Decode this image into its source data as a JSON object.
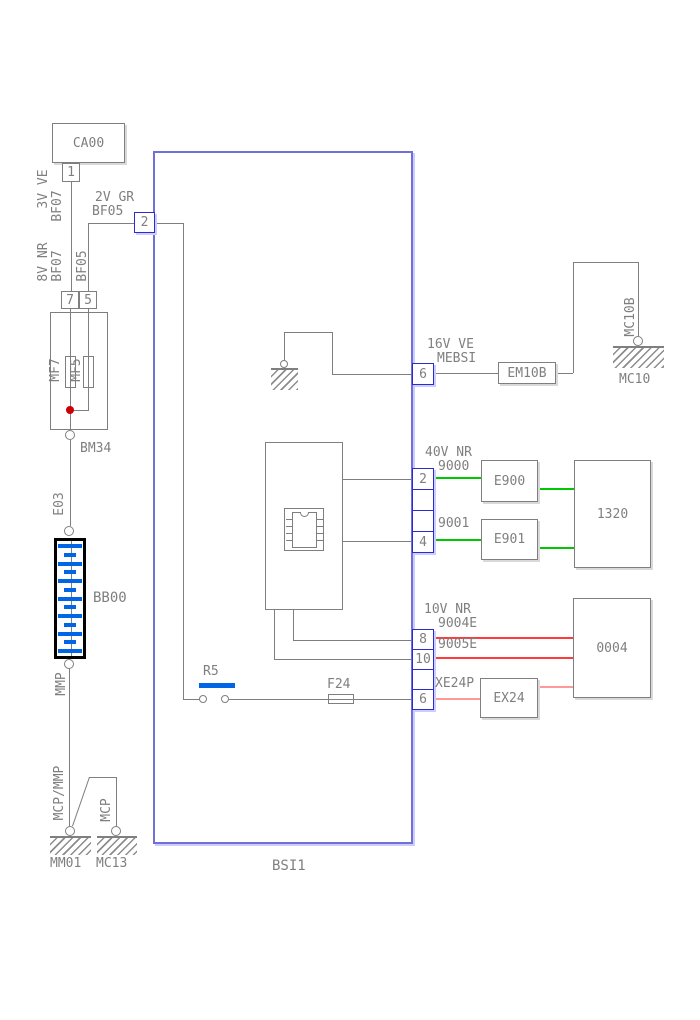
{
  "labels": {
    "ca00": "CA00",
    "p1": "1",
    "v3": "3V VE",
    "bf07_top": "BF07",
    "v2": "2V GR",
    "bf05_top": "BF05",
    "v8": "8V NR",
    "bf07_mid": "BF07",
    "bf05_mid": "BF05",
    "p7": "7",
    "p5": "5",
    "mf7": "MF7",
    "mf5": "MF5",
    "bm34": "BM34",
    "e03": "E03",
    "bb00": "BB00",
    "mmp": "MMP",
    "mcp_mmp": "MCP/MMP",
    "mcp": "MCP",
    "mm01": "MM01",
    "mc13": "MC13",
    "bsi": "BSI1",
    "p2_bf05": "2",
    "r5": "R5",
    "f24": "F24",
    "v16": "16V VE",
    "mebsi": "MEBSI",
    "p6_mebsi": "6",
    "em10b": "EM10B",
    "mc10b": "MC10B",
    "mc10": "MC10",
    "v40": "40V NR",
    "n9000": "9000",
    "p2": "2",
    "e900": "E900",
    "n9001": "9001",
    "p4": "4",
    "e901": "E901",
    "b1320": "1320",
    "v10": "10V NR",
    "n9004e": "9004E",
    "p8": "8",
    "n9005e": "9005E",
    "p10": "10",
    "b0004": "0004",
    "xe24p": "XE24P",
    "p6": "6",
    "ex24": "EX24"
  },
  "battery": {
    "cells": 13
  },
  "colors": {
    "line_gray": "#7f7f7f",
    "bsi_outline": "#7070d8",
    "pin_border": "#2b2bd0",
    "pin_shadow": "#ccccff",
    "wire_green": "#00c800",
    "wire_red": "#ff3b3b",
    "wire_salmon": "#ff9898",
    "battery_blue": "#0066e6",
    "junction_red": "#cc0000"
  }
}
